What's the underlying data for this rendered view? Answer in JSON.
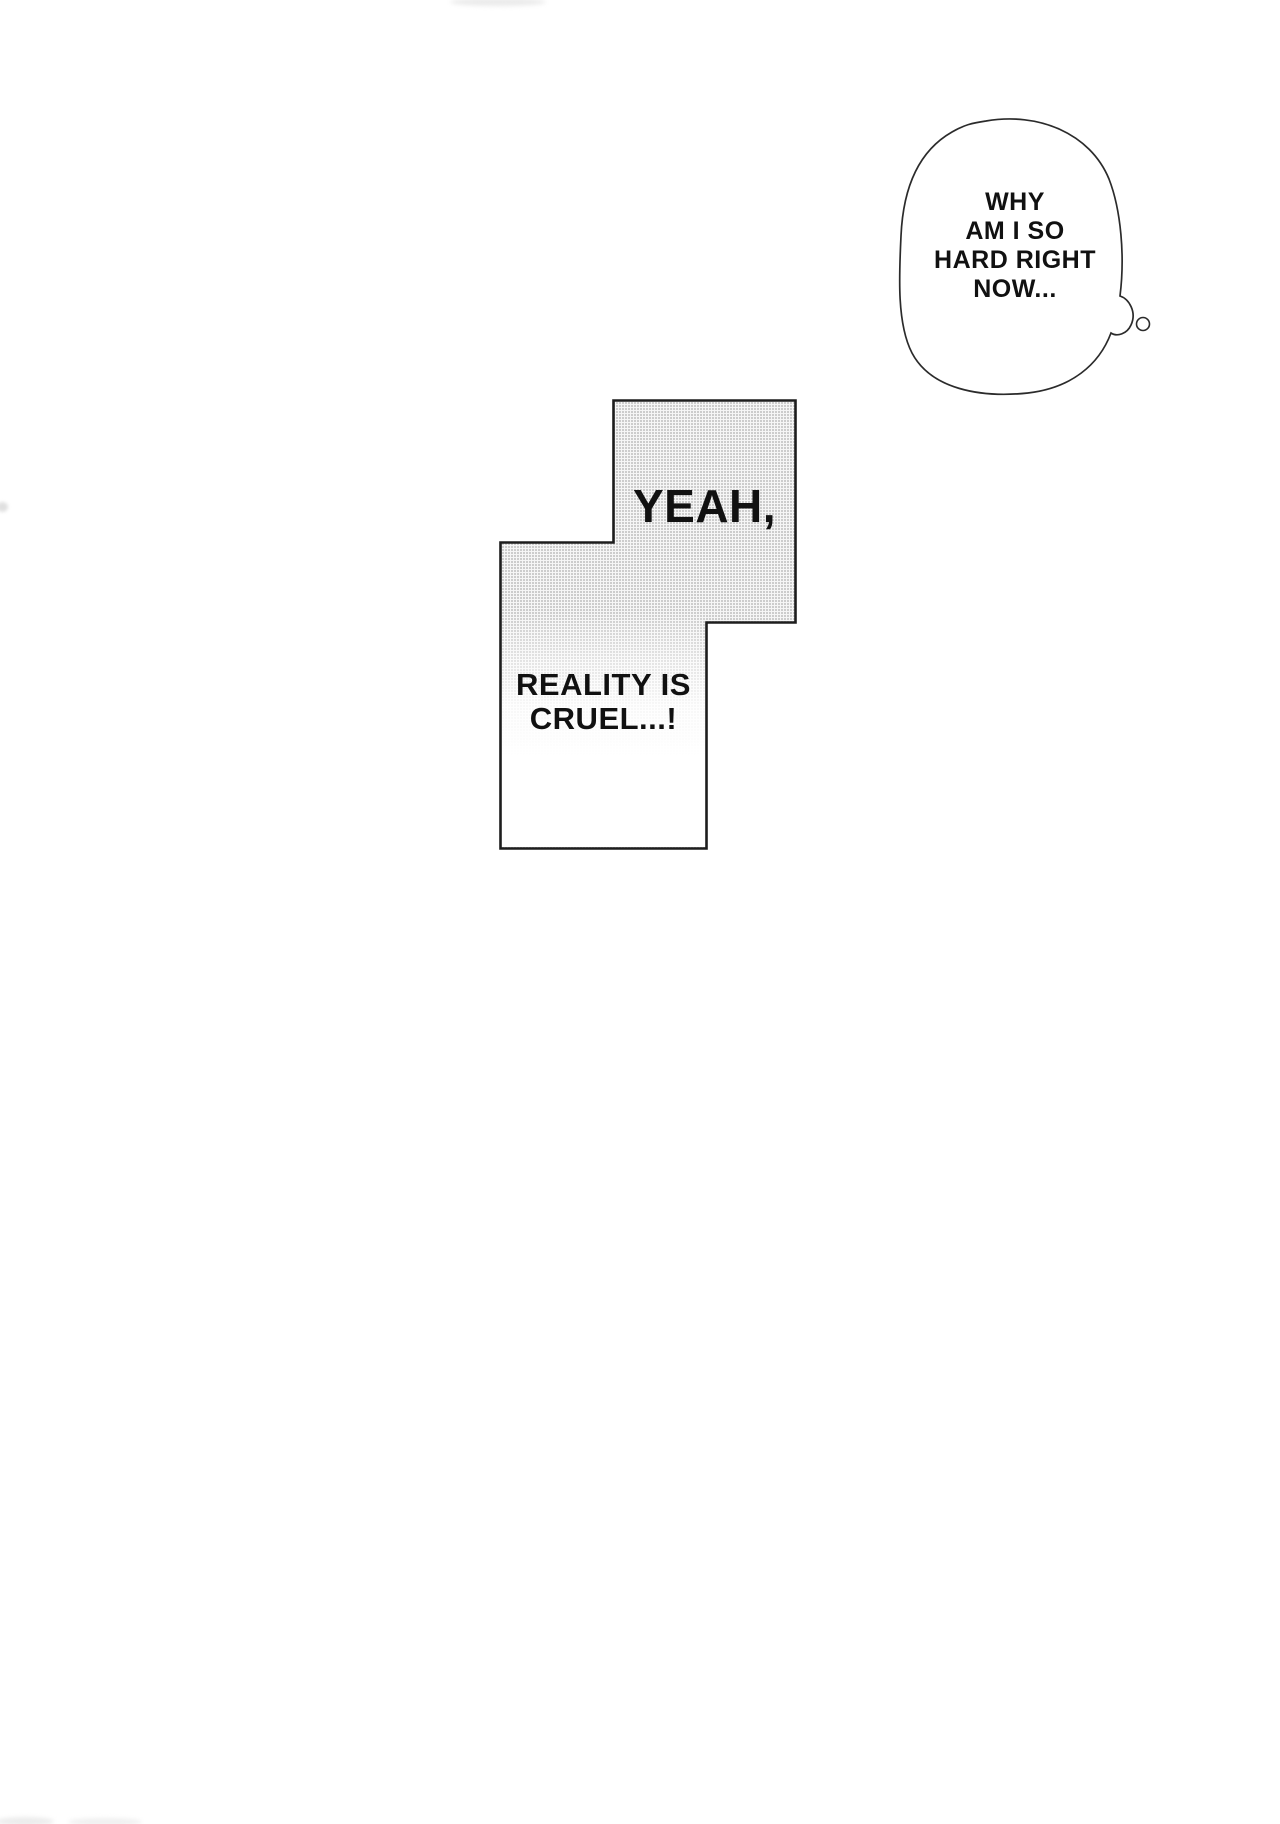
{
  "page": {
    "kind": "manga-page",
    "background_color": "#ffffff",
    "ink_color": "#1d1d1d",
    "tone_color": "#c6c6c6"
  },
  "thought_bubble": {
    "lines": [
      "WHY",
      "AM I SO",
      "HARD RIGHT",
      "NOW..."
    ]
  },
  "caption_panel": {
    "upper_text": "YEAH,",
    "lower_lines": [
      "REALITY IS",
      "CRUEL...!"
    ]
  }
}
